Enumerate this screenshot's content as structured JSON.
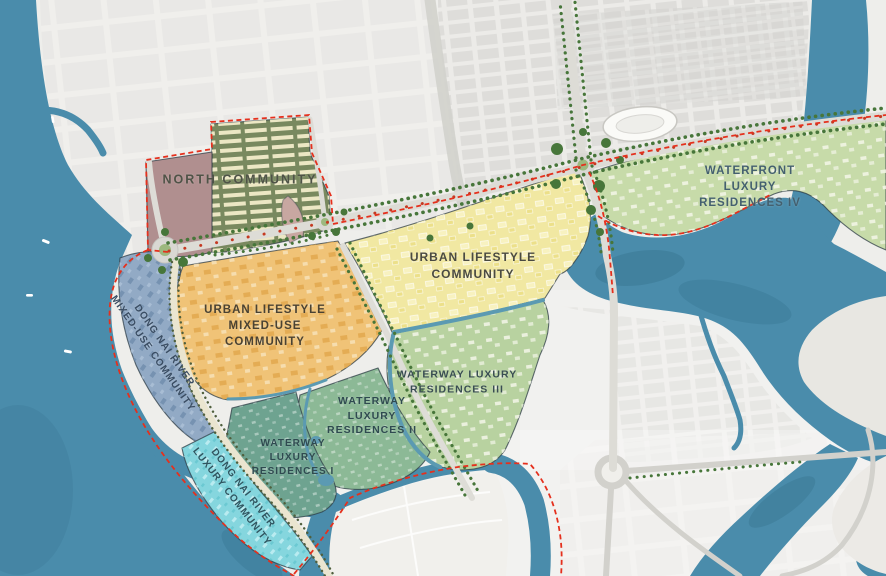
{
  "map": {
    "zones": [
      {
        "id": "north-community",
        "label": "NORTH COMMUNITY",
        "fill": "#79895f",
        "accent_fill": "#b08f8f",
        "text_color": "#4f5347"
      },
      {
        "id": "waterfront-luxury-residences-iv",
        "label": "WATERFRONT LUXURY\nRESIDENCES IV",
        "fill": "#c7dba9",
        "text_color": "#44606f"
      },
      {
        "id": "urban-lifestyle-community",
        "label": "URBAN LIFESTYLE\nCOMMUNITY",
        "fill": "#f1e8a2",
        "text_color": "#4a4a42"
      },
      {
        "id": "urban-lifestyle-mixed-use-community",
        "label": "URBAN LIFESTYLE\nMIXED-USE\nCOMMUNITY",
        "fill": "#f0c377",
        "text_color": "#4a4232"
      },
      {
        "id": "waterway-luxury-residences-iii",
        "label": "WATERWAY LUXURY\nRESIDENCES III",
        "fill": "#b8d2a0",
        "text_color": "#394d52"
      },
      {
        "id": "waterway-luxury-residences-ii",
        "label": "WATERWAY\nLUXURY\nRESIDENCES II",
        "fill": "#8cb996",
        "text_color": "#2f4a50"
      },
      {
        "id": "waterway-luxury-residences-i",
        "label": "WATERWAY\nLUXURY\nRESIDENCES I",
        "fill": "#6ea390",
        "text_color": "#2f4a50"
      },
      {
        "id": "dong-nai-river-mixed-use-community",
        "label": "DONG NAI RIVER\nMIXED-USE COMMUNITY",
        "fill": "#92aac5",
        "text_color": "#3a4d63"
      },
      {
        "id": "dong-nai-river-luxury-community",
        "label": "DONG NAI RIVER\nLUXURY COMMUNITY",
        "fill": "#85d6de",
        "text_color": "#2f5560"
      }
    ],
    "palette": {
      "water": "#4a8cab",
      "water_deep": "#3a7894",
      "boundary_red": "#e5301d",
      "road": "#dddcd6",
      "tree_green": "#47763a",
      "tree_red": "#c53a22",
      "land": "#e9e8e4",
      "city_block": "#d2d1cd",
      "pink_parcel": "#c8a7a1"
    }
  }
}
